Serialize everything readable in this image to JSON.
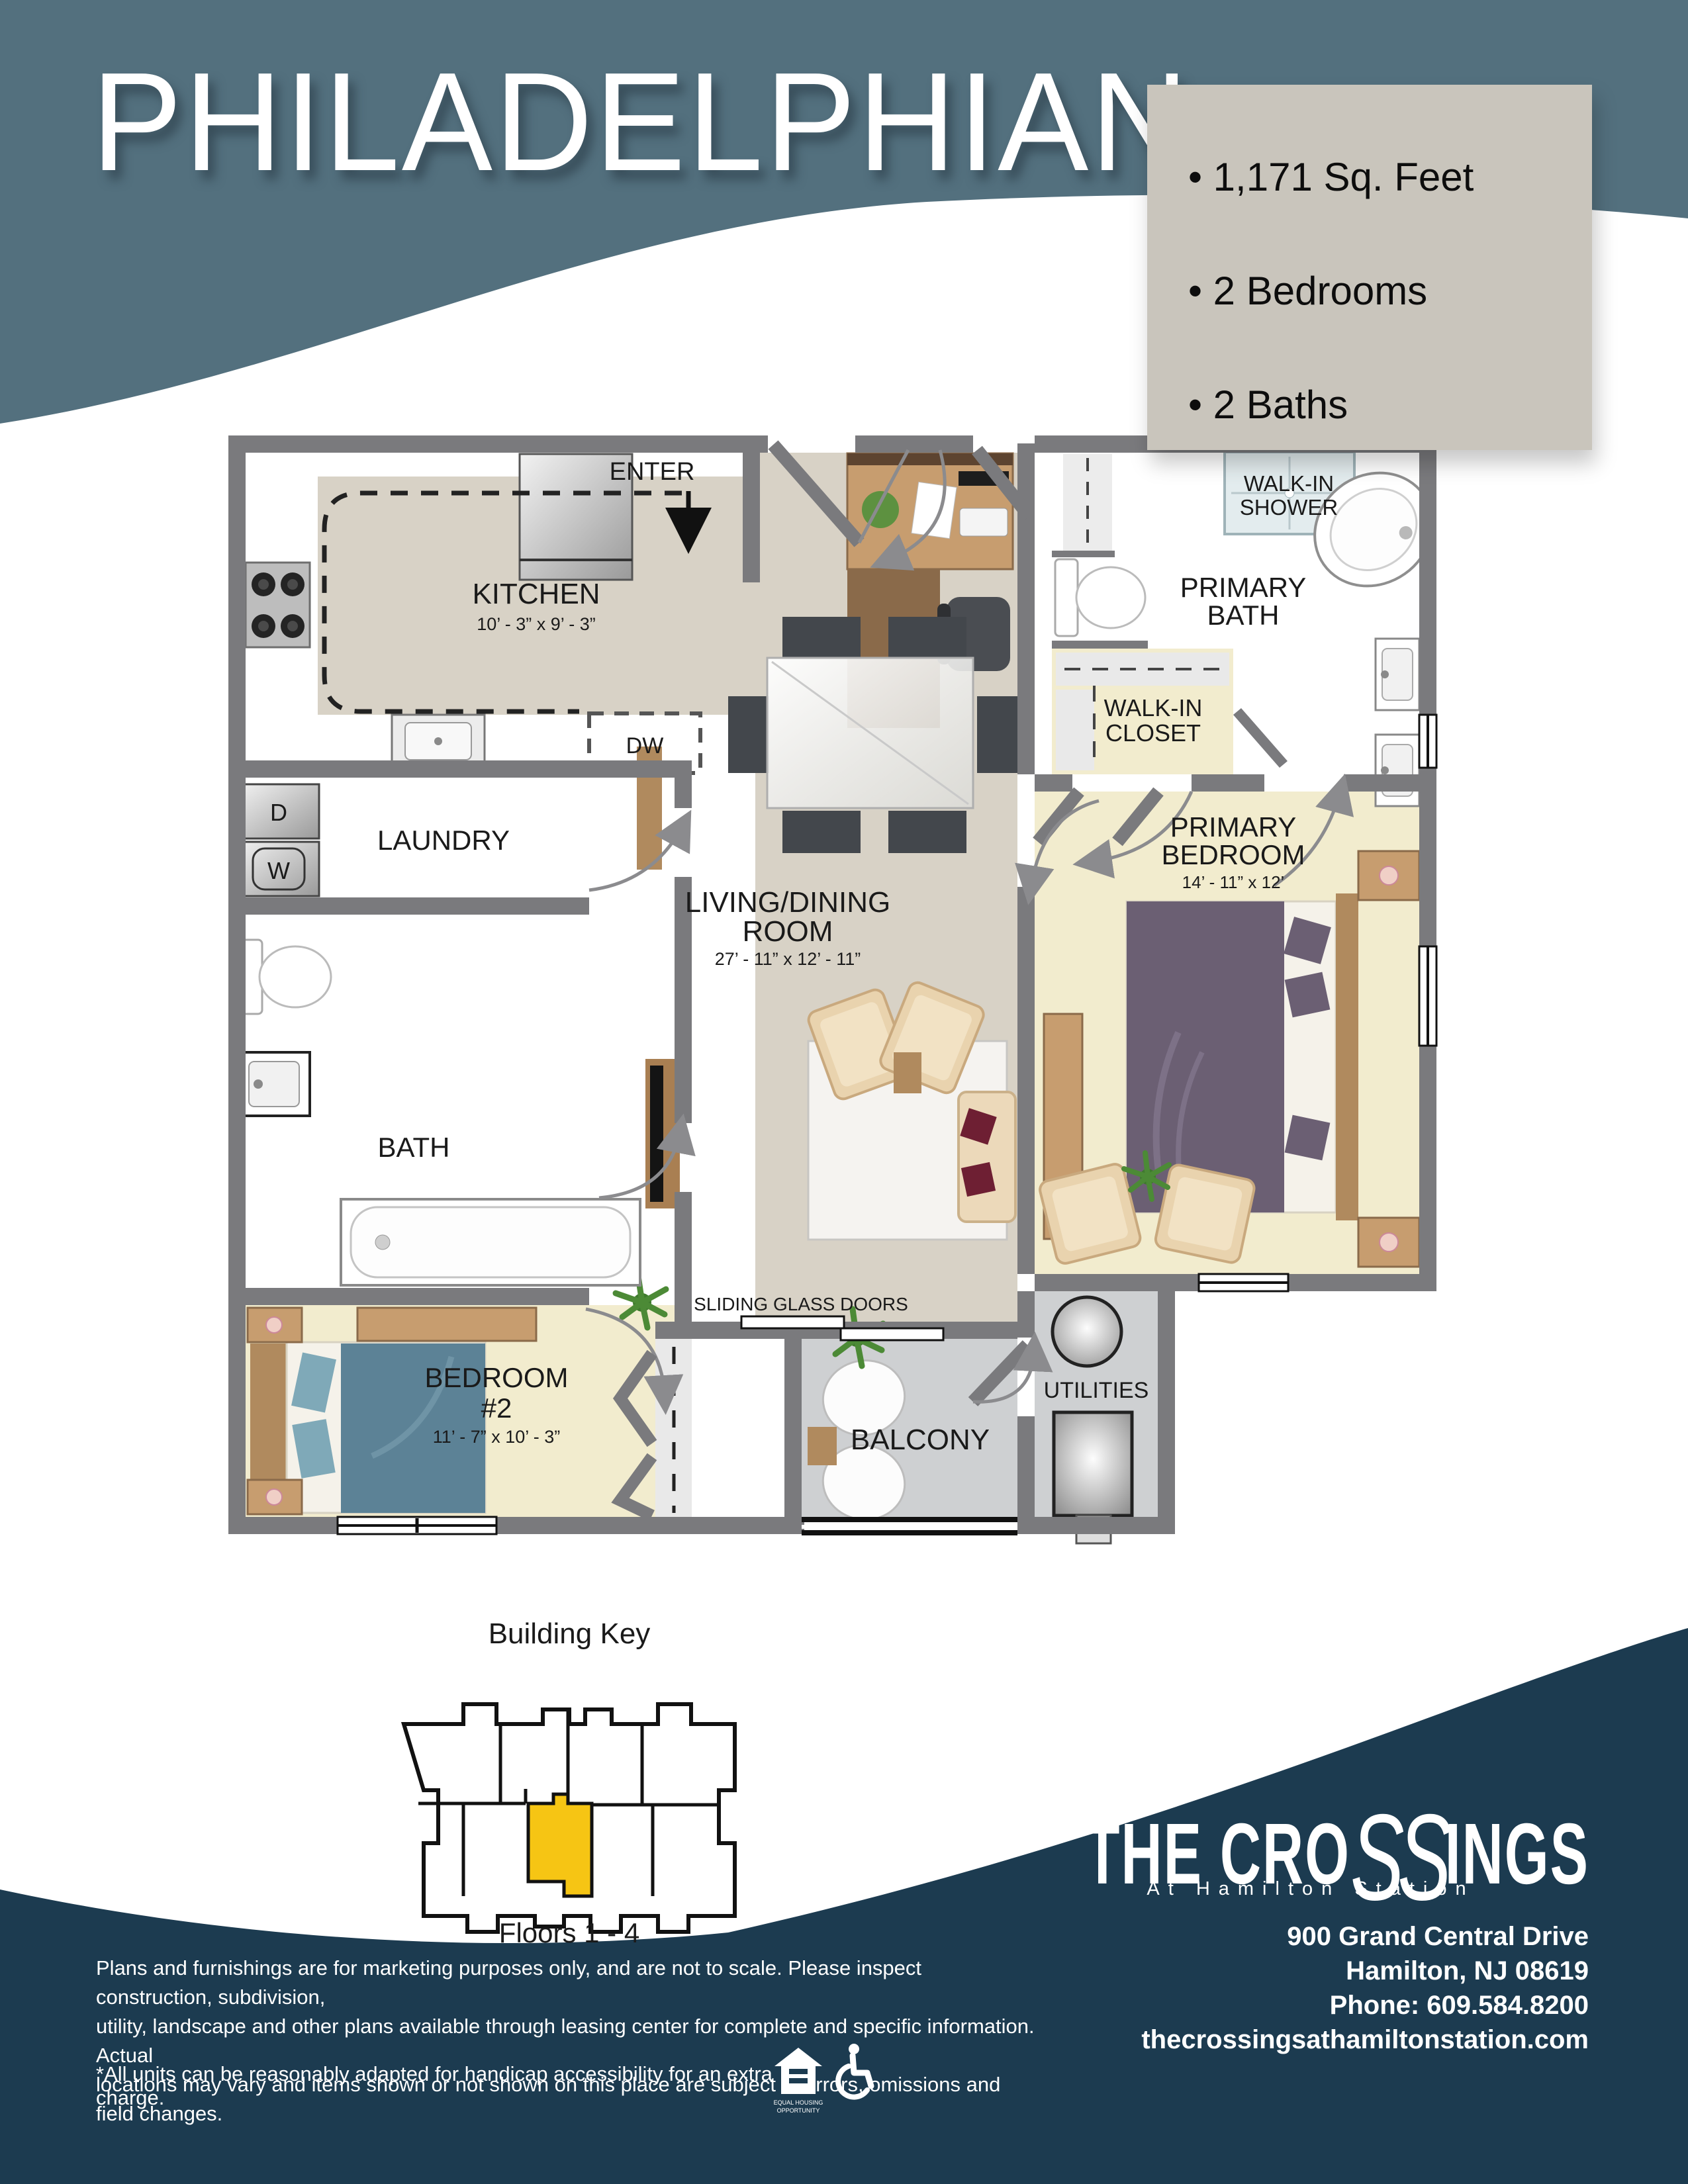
{
  "header": {
    "title": "PHILADELPHIAN",
    "stats": [
      "• 1,171 Sq. Feet",
      "• 2 Bedrooms",
      "• 2 Baths"
    ]
  },
  "fp": {
    "kitchen": {
      "name": "KITCHEN",
      "dims": "10’ - 3” x 9’ - 3”"
    },
    "living": {
      "l1": "LIVING/DINING",
      "l2": "ROOM",
      "dims": "27’ - 11” x 12’ - 11”"
    },
    "primary_bedroom": {
      "l1": "PRIMARY",
      "l2": "BEDROOM",
      "dims": "14’ - 11” x 12’"
    },
    "bedroom2": {
      "l1": "BEDROOM",
      "l2": "#2",
      "dims": "11’ - 7” x 10’ - 3”"
    },
    "primary_bath": {
      "l1": "PRIMARY",
      "l2": "BATH"
    },
    "shower": {
      "l1": "WALK-IN",
      "l2": "SHOWER"
    },
    "closet": {
      "l1": "WALK-IN",
      "l2": "CLOSET"
    },
    "laundry": {
      "name": "LAUNDRY"
    },
    "bath": {
      "name": "BATH"
    },
    "balcony": {
      "name": "BALCONY"
    },
    "utilities": {
      "name": "UTILITIES"
    },
    "enter": "ENTER",
    "sliding": "SLIDING GLASS DOORS",
    "dw": "DW",
    "dryer": "D",
    "washer": "W"
  },
  "key": {
    "title": "Building Key",
    "caption": "Floors 1 - 4"
  },
  "footer": {
    "line1": "Plans and furnishings are for marketing purposes only, and are not to scale. Please inspect construction, subdivision,",
    "line2": "utility, landscape and other plans available through leasing center for complete and specific information. Actual",
    "line3": "locations may vary and items shown or not shown on this place are subject to errors, omissions and field changes.",
    "note": "*All units can be reasonably adapted for handicap accessibility for an extra charge.",
    "eho1": "EQUAL HOUSING",
    "eho2": "OPPORTUNITY"
  },
  "brand": {
    "part1": "THE CRO",
    "part2": "SS",
    "part3": "INGS",
    "tagline": "At Hamilton Station",
    "addr1": "900 Grand Central Drive",
    "addr2": "Hamilton, NJ 08619",
    "addr3": "Phone: 609.584.8200",
    "addr4": "thecrossingsathamiltonstation.com"
  },
  "colors": {
    "header_slate": "#53707e",
    "footer_navy": "#1c3b50",
    "stats_box": "#c9c5bc",
    "unit_highlight": "#f6c514",
    "wall_gray": "#7a7a7d",
    "floor_beige": "#d8d2c6",
    "floor_yellow": "#f2ecce"
  }
}
